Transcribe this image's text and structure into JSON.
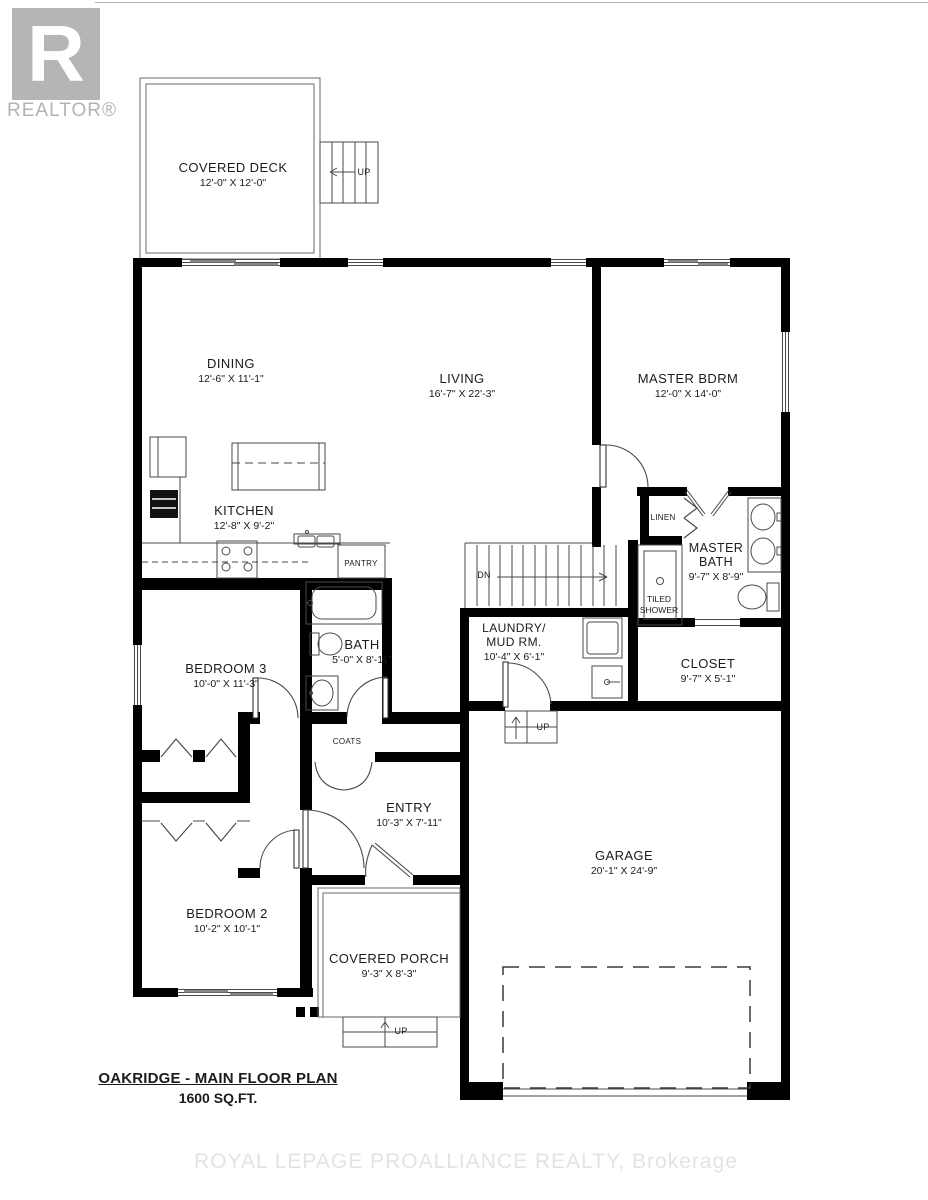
{
  "branding": {
    "realtor_logo_letter": "R",
    "realtor_text": "REALTOR®",
    "watermark": "ROYAL LEPAGE PROALLIANCE REALTY, Brokerage"
  },
  "title": {
    "line1": "OAKRIDGE - MAIN FLOOR PLAN",
    "line2": "1600 SQ.FT."
  },
  "rooms": {
    "covered_deck": {
      "name": "COVERED DECK",
      "dims": "12'-0\" X 12'-0\""
    },
    "dining": {
      "name": "DINING",
      "dims": "12'-6\" X 11'-1\""
    },
    "living": {
      "name": "LIVING",
      "dims": "16'-7\" X 22'-3\""
    },
    "master_bdrm": {
      "name": "MASTER BDRM",
      "dims": "12'-0\" X 14'-0\""
    },
    "kitchen": {
      "name": "KITCHEN",
      "dims": "12'-8\" X 9'-2\""
    },
    "pantry": {
      "name": "PANTRY"
    },
    "linen": {
      "name": "LINEN"
    },
    "master_bath": {
      "name_line1": "MASTER",
      "name_line2": "BATH",
      "dims": "9'-7\" X 8'-9\""
    },
    "tiled_shower": {
      "name_line1": "TILED",
      "name_line2": "SHOWER"
    },
    "closet": {
      "name": "CLOSET",
      "dims": "9'-7\" X 5'-1\""
    },
    "laundry": {
      "name_line1": "LAUNDRY/",
      "name_line2": "MUD RM.",
      "dims": "10'-4\" X 6'-1\""
    },
    "bath": {
      "name": "BATH",
      "dims": "5'-0\" X 8'-11\""
    },
    "bedroom3": {
      "name": "BEDROOM 3",
      "dims": "10'-0\" X 11'-3\""
    },
    "bedroom2": {
      "name": "BEDROOM 2",
      "dims": "10'-2\" X 10'-1\""
    },
    "coats": {
      "name": "COATS"
    },
    "entry": {
      "name": "ENTRY",
      "dims": "10'-3\" X 7'-11\""
    },
    "covered_porch": {
      "name": "COVERED PORCH",
      "dims": "9'-3\" X 8'-3\""
    },
    "garage": {
      "name": "GARAGE",
      "dims": "20'-1\" X 24'-9\""
    }
  },
  "annotations": {
    "stairs_up_deck": "UP",
    "stairs_dn": "DN",
    "step_up_garage": "UP",
    "steps_up_porch": "UP"
  },
  "colors": {
    "wall": "#000000",
    "line": "#4a4a4a",
    "logo_gray": "#b5b5b5",
    "watermark_gray": "#e3e3e3"
  }
}
